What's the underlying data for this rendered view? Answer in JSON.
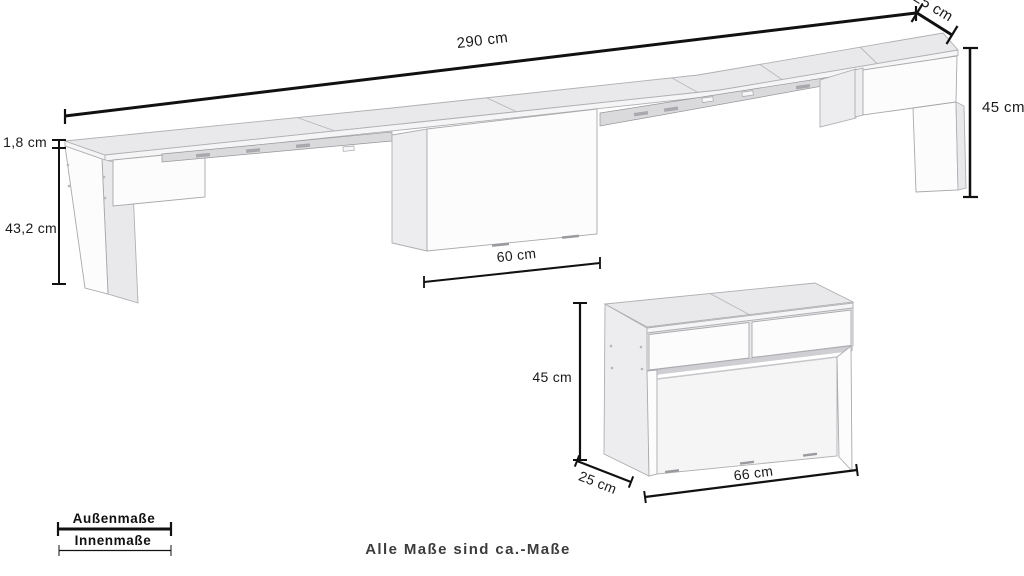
{
  "note": "Alle Maße sind ca.-Maße",
  "legend": {
    "outer": "Außenmaße",
    "inner": "Innenmaße"
  },
  "bench_extended": {
    "length": "290 cm",
    "depth": "25 cm",
    "height": "45 cm",
    "top_thickness": "1,8 cm",
    "clearance_height": "43,2 cm",
    "pedestal_width": "60 cm"
  },
  "bench_compact": {
    "height": "45 cm",
    "depth": "25 cm",
    "width": "66 cm"
  },
  "colors": {
    "background": "#ffffff",
    "dimension_line": "#111111",
    "dimension_text": "#1a1a1a",
    "note_text": "#3c3c3c",
    "face_top": "#e9e9eb",
    "face_front": "#fcfcfd",
    "face_side": "#ededef"
  }
}
